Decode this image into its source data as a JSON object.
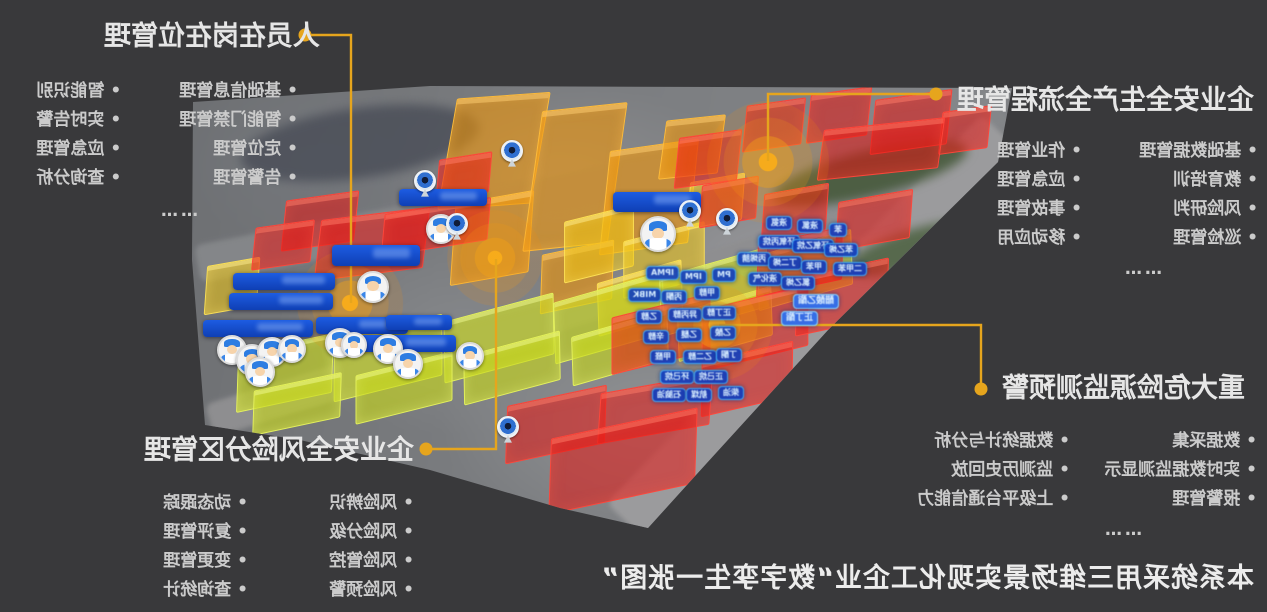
{
  "colors": {
    "background": "#39393b",
    "accent": "#E6A51D",
    "title_text": "#e6e6e6",
    "item_text": "#cbcbcb",
    "tag_bg": "#103ebe",
    "tag_border": "#43a9f5",
    "bar_bg": "#1d5ce2",
    "building_red": "#e61612",
    "building_orange": "#ee9408",
    "building_yellow": "#f0c612",
    "building_lime": "#c8d81a"
  },
  "note": "entire screenshot is horizontally mirrored",
  "callouts": [
    {
      "id": "personnel",
      "title": "人员在岗在位管理",
      "columns": [
        [
          "基础信息管理",
          "智能门禁管理",
          "定位管理",
          "告警管理"
        ],
        [
          "智能识别",
          "实时告警",
          "应急管理",
          "查询分析"
        ]
      ],
      "more": "……"
    },
    {
      "id": "process",
      "title": "企业安全生产全流程管理",
      "columns": [
        [
          "基础数据管理",
          "教育培训",
          "风险研判",
          "巡检管理"
        ],
        [
          "作业管理",
          "应急管理",
          "事故管理",
          "移动应用"
        ]
      ],
      "more": "……"
    },
    {
      "id": "hazard",
      "title": "重大危险源监测预警",
      "columns": [
        [
          "数据采集",
          "实时数据监测显示",
          "报警管理"
        ],
        [
          "数据统计与分析",
          "监测历史回放",
          "上级平台通信能力"
        ]
      ],
      "more": "……"
    },
    {
      "id": "risk",
      "title": "企业安全风险分区管理",
      "columns": [
        [
          "风险辨识",
          "风险分级",
          "风险管控",
          "风险预警"
        ],
        [
          "动态跟踪",
          "复评管理",
          "变更管理",
          "查询统计"
        ]
      ],
      "more": "……"
    }
  ],
  "caption": "本系统采用三维场景实现化工企业“数字孪生一张图”",
  "icons": {
    "avatar": "worker-avatar-icon",
    "camera": "webcam-icon",
    "hotspot": "alarm-hotspot-icon",
    "connector_dot": "callout-dot"
  },
  "map": {
    "buildings": [
      [
        447,
        96,
        92,
        108,
        "orange",
        -4
      ],
      [
        452,
        198,
        78,
        78,
        "orange",
        -10
      ],
      [
        532,
        108,
        84,
        136,
        "orange",
        -6
      ],
      [
        604,
        146,
        88,
        100,
        "orange",
        -8
      ],
      [
        662,
        118,
        58,
        56,
        "orange",
        -6
      ],
      [
        540,
        248,
        72,
        56,
        "orange",
        -12
      ],
      [
        563,
        214,
        70,
        58,
        "yellow",
        -14
      ],
      [
        622,
        232,
        82,
        54,
        "yellow",
        -14
      ],
      [
        688,
        178,
        54,
        44,
        "yellow",
        -10
      ],
      [
        596,
        272,
        86,
        50,
        "yellow",
        -16
      ],
      [
        205,
        262,
        52,
        46,
        "yellow",
        -10
      ],
      [
        236,
        344,
        96,
        56,
        "lime",
        -12
      ],
      [
        332,
        328,
        110,
        58,
        "lime",
        -14
      ],
      [
        442,
        308,
        112,
        58,
        "lime",
        -15
      ],
      [
        552,
        288,
        112,
        58,
        "lime",
        -16
      ],
      [
        658,
        263,
        110,
        56,
        "lime",
        -16
      ],
      [
        756,
        243,
        96,
        52,
        "lime",
        -16
      ],
      [
        252,
        382,
        88,
        42,
        "lime",
        -12
      ],
      [
        354,
        364,
        98,
        46,
        "lime",
        -14
      ],
      [
        462,
        344,
        98,
        46,
        "lime",
        -15
      ],
      [
        570,
        324,
        98,
        46,
        "lime",
        -16
      ],
      [
        676,
        300,
        96,
        46,
        "lime",
        -16
      ],
      [
        676,
        134,
        62,
        48,
        "red",
        -8
      ],
      [
        744,
        102,
        58,
        44,
        "red",
        -8
      ],
      [
        808,
        91,
        60,
        46,
        "red",
        -8
      ],
      [
        872,
        95,
        76,
        52,
        "red",
        -8
      ],
      [
        940,
        109,
        48,
        40,
        "red",
        -8
      ],
      [
        820,
        124,
        120,
        48,
        "red",
        -6
      ],
      [
        700,
        181,
        56,
        40,
        "red",
        -10
      ],
      [
        762,
        189,
        64,
        44,
        "red",
        -10
      ],
      [
        836,
        196,
        74,
        46,
        "red",
        -10
      ],
      [
        283,
        196,
        72,
        48,
        "red",
        -8
      ],
      [
        253,
        224,
        58,
        40,
        "red",
        -8
      ],
      [
        317,
        214,
        108,
        58,
        "red",
        -7
      ],
      [
        382,
        206,
        106,
        40,
        "red",
        -9
      ],
      [
        437,
        156,
        52,
        38,
        "red",
        -9
      ],
      [
        610,
        306,
        100,
        54,
        "red",
        -14
      ],
      [
        700,
        298,
        108,
        58,
        "red",
        -14
      ],
      [
        756,
        236,
        86,
        50,
        "red",
        -12
      ],
      [
        795,
        268,
        92,
        56,
        "red",
        -12
      ],
      [
        700,
        352,
        92,
        52,
        "red",
        -13
      ],
      [
        505,
        396,
        100,
        55,
        "red",
        -12
      ],
      [
        598,
        384,
        112,
        48,
        "red",
        -10
      ],
      [
        548,
        424,
        148,
        72,
        "red",
        -12
      ]
    ],
    "bars": [
      [
        399,
        189,
        88,
        17
      ],
      [
        613,
        192,
        88,
        20
      ],
      [
        332,
        245,
        88,
        21
      ],
      [
        233,
        273,
        102,
        17
      ],
      [
        229,
        293,
        104,
        17
      ],
      [
        203,
        320,
        110,
        17
      ],
      [
        316,
        317,
        92,
        17
      ],
      [
        360,
        335,
        96,
        17
      ],
      [
        386,
        315,
        66,
        15
      ]
    ],
    "tags": [
      [
        766,
        216,
        "液氨",
        0
      ],
      [
        797,
        219,
        "液氯",
        0
      ],
      [
        829,
        223,
        "苯",
        0
      ],
      [
        758,
        235,
        "环氧丙烷",
        0
      ],
      [
        792,
        239,
        "环氧乙烷",
        0
      ],
      [
        824,
        243,
        "苯乙烯",
        0
      ],
      [
        737,
        252,
        "丙烯腈",
        0
      ],
      [
        768,
        256,
        "丁二烯",
        0
      ],
      [
        801,
        260,
        "甲苯",
        0
      ],
      [
        833,
        262,
        "二甲苯",
        0
      ],
      [
        748,
        272,
        "液化气",
        0
      ],
      [
        781,
        276,
        "氯乙烯",
        0
      ],
      [
        646,
        266,
        "IPMA",
        0
      ],
      [
        680,
        270,
        "IPM",
        0
      ],
      [
        712,
        268,
        "PM",
        0
      ],
      [
        628,
        288,
        "MIBK",
        0
      ],
      [
        661,
        290,
        "丙酮",
        0
      ],
      [
        694,
        286,
        "甲醇",
        0
      ],
      [
        636,
        310,
        "乙醇",
        0
      ],
      [
        668,
        308,
        "异丙醇",
        0
      ],
      [
        702,
        306,
        "正丁醇",
        0
      ],
      [
        643,
        330,
        "辛醇",
        0
      ],
      [
        676,
        328,
        "乙醚",
        0
      ],
      [
        710,
        326,
        "乙酸",
        0
      ],
      [
        650,
        350,
        "甲醛",
        0
      ],
      [
        683,
        350,
        "乙二醇",
        0
      ],
      [
        716,
        348,
        "丁酮",
        0
      ],
      [
        660,
        370,
        "环己烷",
        0
      ],
      [
        694,
        370,
        "正己烷",
        0
      ],
      [
        652,
        388,
        "石脑油",
        0
      ],
      [
        686,
        388,
        "航煤",
        0
      ],
      [
        718,
        386,
        "柴油",
        0
      ],
      [
        793,
        294,
        "醋酸乙酯",
        1
      ],
      [
        781,
        311,
        "正丁酯",
        1
      ]
    ],
    "avatars": [
      [
        658,
        234,
        36
      ],
      [
        441,
        229,
        30
      ],
      [
        373,
        287,
        32
      ],
      [
        340,
        343,
        30
      ],
      [
        354,
        345,
        26
      ],
      [
        388,
        349,
        30
      ],
      [
        408,
        364,
        30
      ],
      [
        470,
        356,
        28
      ],
      [
        232,
        350,
        30
      ],
      [
        252,
        360,
        32
      ],
      [
        272,
        352,
        30
      ],
      [
        292,
        349,
        28
      ],
      [
        260,
        372,
        30
      ]
    ],
    "cameras": [
      [
        512,
        151
      ],
      [
        425,
        181
      ],
      [
        457,
        224
      ],
      [
        690,
        211
      ],
      [
        727,
        219
      ],
      [
        508,
        427
      ]
    ],
    "hotspots": [
      [
        350,
        303,
        1.0
      ],
      [
        495,
        258,
        0.9
      ],
      [
        768,
        162,
        1.15
      ],
      [
        717,
        325,
        1.05
      ]
    ]
  }
}
